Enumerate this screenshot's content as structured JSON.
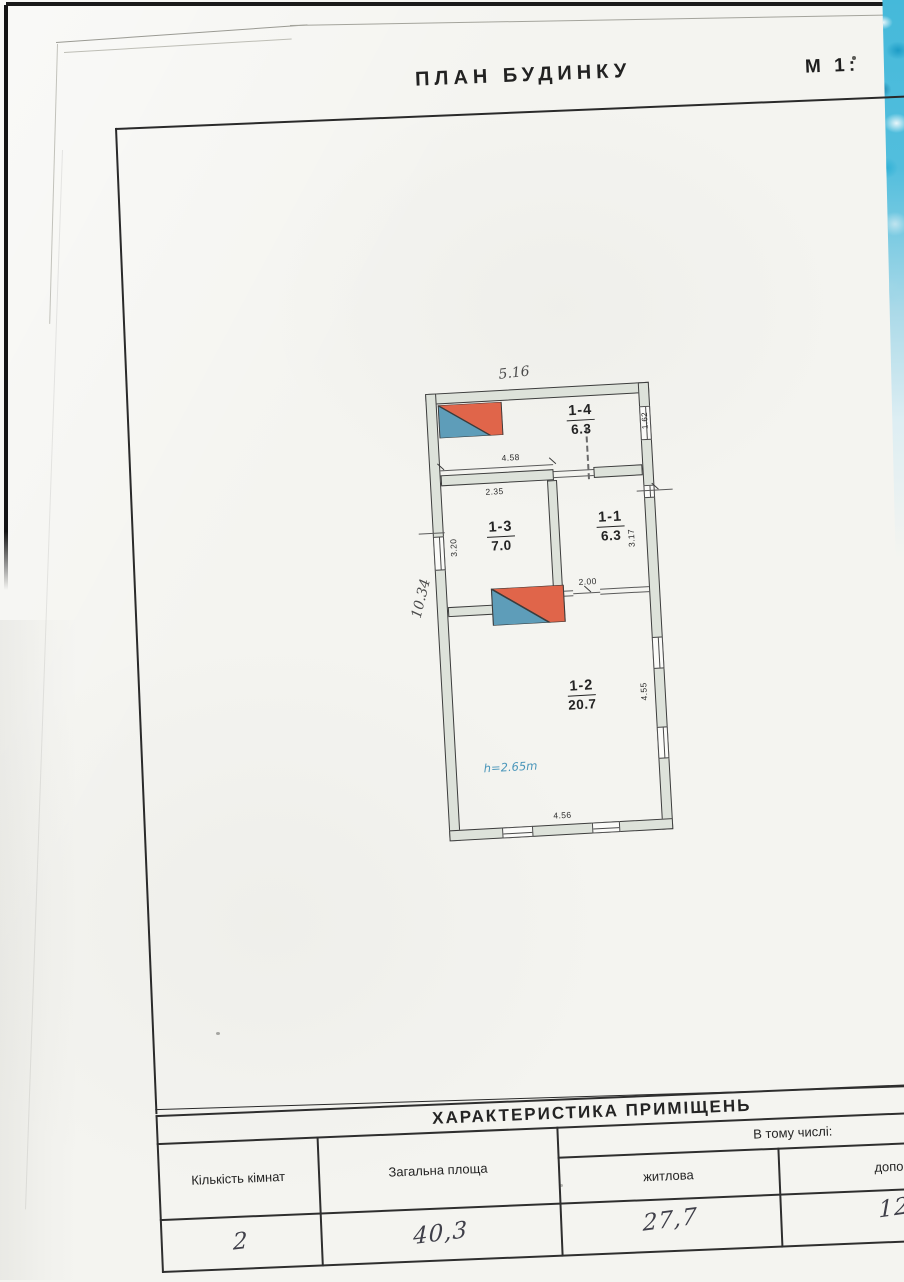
{
  "page": {
    "title": "ПЛАН  БУДИНКУ",
    "scale_label": "М 1:"
  },
  "plan": {
    "rooms": [
      {
        "id": "1-4",
        "area": "6.3"
      },
      {
        "id": "1-3",
        "area": "7.0"
      },
      {
        "id": "1-1",
        "area": "6.3"
      },
      {
        "id": "1-2",
        "area": "20.7"
      }
    ],
    "height_note": "h=2.65m",
    "dims": {
      "top": "5.16",
      "left_side": "10.34",
      "win_162": "1.62",
      "inner_458": "4.58",
      "inner_235": "2.35",
      "left_320": "3.20",
      "right_317": "3.17",
      "door_200": "2.00",
      "right_455": "4.55",
      "bottom_456": "4.56"
    }
  },
  "table": {
    "title": "ХАРАКТЕРИСТИКА   ПРИМІЩЕНЬ",
    "including": "В тому числі:",
    "columns": {
      "rooms": "Кількість кімнат",
      "total": "Загальна площа",
      "living": "житлова",
      "aux": "допоміжні"
    },
    "values": {
      "rooms": "2",
      "total": "40,3",
      "living": "27,7",
      "aux": "12,6"
    }
  }
}
